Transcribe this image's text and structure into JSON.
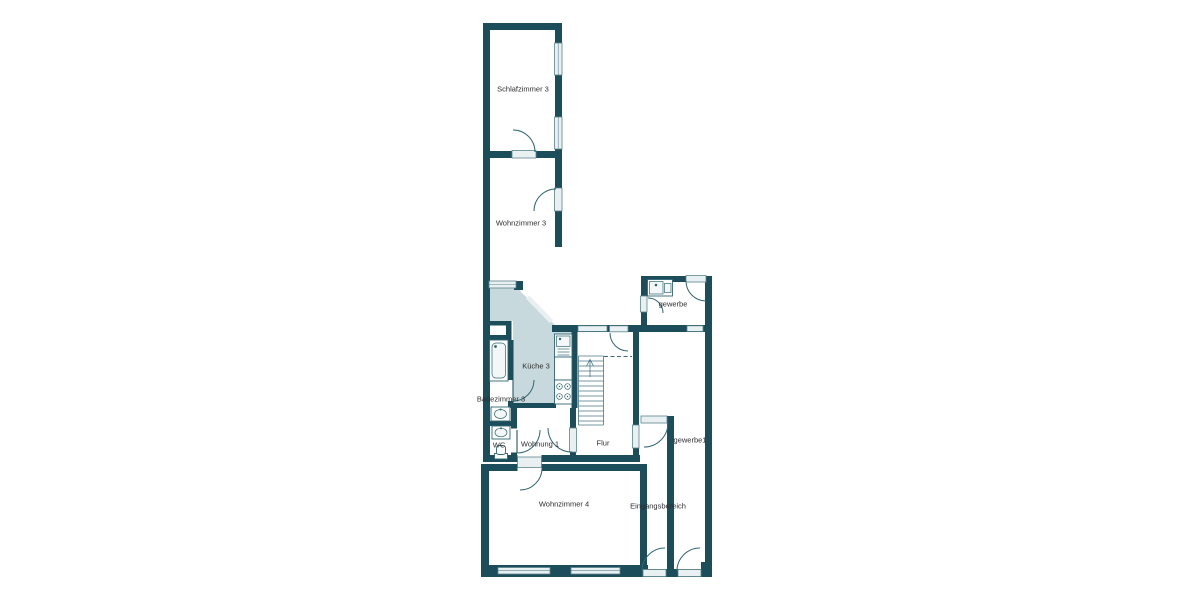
{
  "colors": {
    "wall": "#1c4d5a",
    "room_shade": "#c7d9dc",
    "window_fill": "#e9f0f1",
    "door_line": "#2f6573",
    "background": "#ffffff",
    "label_text": "#2d2d2d"
  },
  "rooms": {
    "schlafzimmer3": {
      "label": "Schlafzimmer 3"
    },
    "wohnzimmer3": {
      "label": "Wohnzimmer 3"
    },
    "kueche3": {
      "label": "Küche 3"
    },
    "badezimmer3": {
      "label": "Badezimmer 3"
    },
    "wc": {
      "label": "WC"
    },
    "wohnung1": {
      "label": "Wohnung 1"
    },
    "flur": {
      "label": "Flur"
    },
    "gewerbe": {
      "label": "gewerbe"
    },
    "gewerbe1": {
      "label": "gewerbe1"
    },
    "wohnzimmer4": {
      "label": "Wohnzimmer 4"
    },
    "eingangsbereich": {
      "label": "Eingangsbereich"
    }
  }
}
